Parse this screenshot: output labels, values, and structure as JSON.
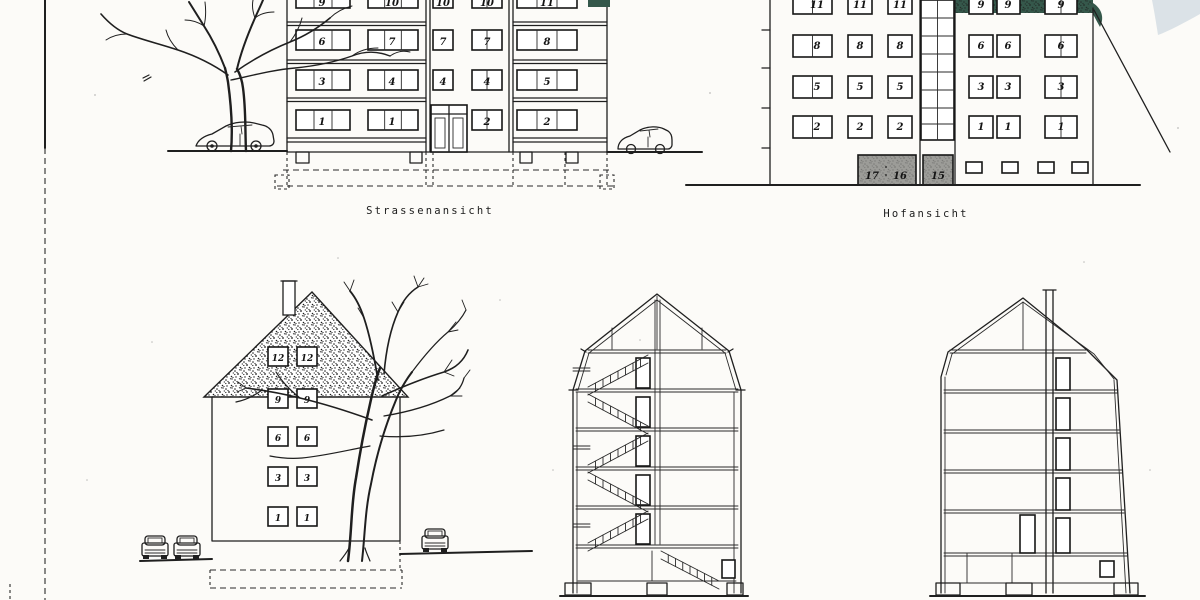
{
  "labels": {
    "street_view": "Strassenansicht",
    "courtyard_view": "Hofansicht"
  },
  "street_elevation": {
    "top_row_numbers": [
      "9",
      "10",
      "10",
      "10",
      "11"
    ],
    "floor3_numbers": [
      "6",
      "7",
      "7",
      "7",
      "8"
    ],
    "floor2_numbers": [
      "3",
      "4",
      "4",
      "4",
      "5"
    ],
    "floor1_numbers": [
      "1",
      "1",
      "2",
      "2"
    ]
  },
  "courtyard_elevation": {
    "left_wing_rows": [
      [
        "11",
        "11",
        "11"
      ],
      [
        "8",
        "8",
        "8"
      ],
      [
        "5",
        "5",
        "5"
      ],
      [
        "2",
        "2",
        "2"
      ]
    ],
    "right_wing_rows": [
      [
        "9",
        "9",
        "9"
      ],
      [
        "6",
        "6",
        "6"
      ],
      [
        "3",
        "3",
        "3"
      ],
      [
        "1",
        "1",
        "1"
      ]
    ],
    "garage_door_numbers": [
      "17",
      "16",
      "15"
    ]
  },
  "gable_elevation": {
    "roof_numbers": [
      "12",
      "12"
    ],
    "floor_rows": [
      [
        "9",
        "9"
      ],
      [
        "6",
        "6"
      ],
      [
        "3",
        "3"
      ],
      [
        "1",
        "1"
      ]
    ]
  },
  "colors": {
    "ink": "#1f1f1f",
    "paper": "#fcfbf8",
    "hedge_green": "#35584b",
    "garage_gray": "#9c9c98",
    "corner_smudge": "#b9c9d6"
  }
}
